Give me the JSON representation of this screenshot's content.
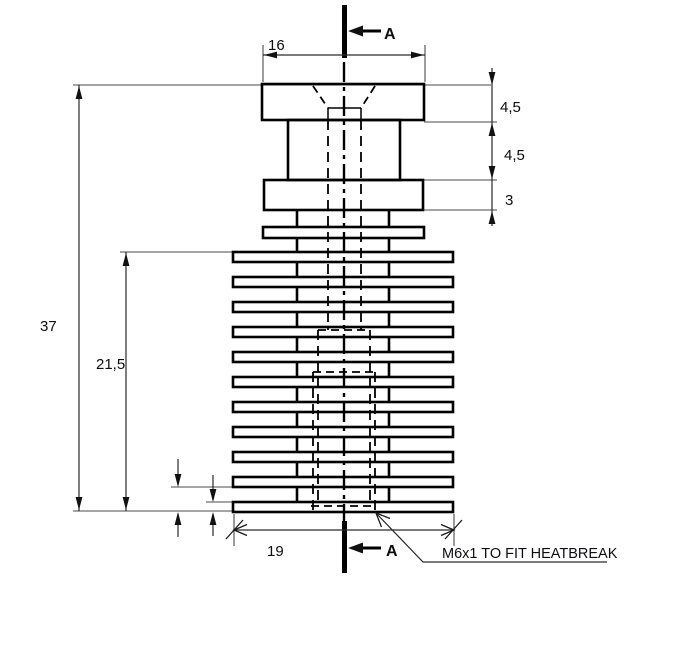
{
  "drawing": {
    "type": "technical-drawing",
    "subject": "heatsink cross-section",
    "note": {
      "text": "M6x1 TO FIT HEATBREAK"
    },
    "section": {
      "top_label": "A",
      "bottom_label": "A"
    },
    "dimensions": {
      "top_width": "16",
      "cap_height": "4,5",
      "neck_height": "4,5",
      "flange_height": "3",
      "total_height": "37",
      "fin_section_height": "21,5",
      "bottom_width": "19"
    },
    "colors": {
      "background": "#ffffff",
      "outline": "#000000",
      "dimension_lines": "#2a2a2a",
      "text": "#0d0d12"
    }
  }
}
